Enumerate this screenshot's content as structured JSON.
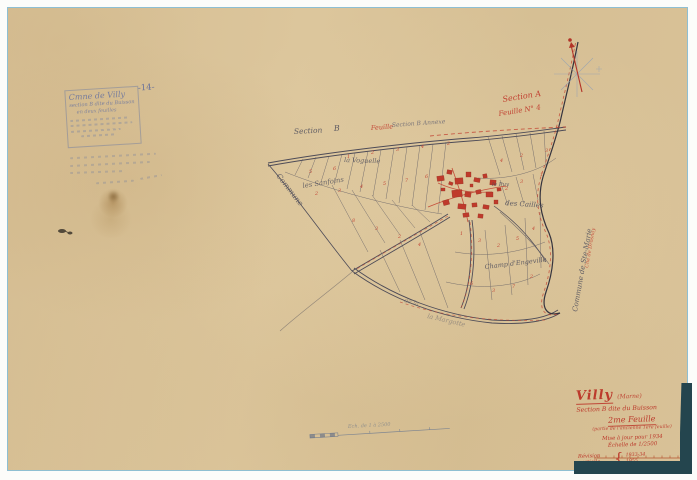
{
  "document_type": "cadastral-map-scan",
  "colors": {
    "paper": "#d8c298",
    "frame_blue": "#8fbfd2",
    "map_ink": "#4b4b5a",
    "red_ink": "#c03a2c",
    "pencil_blue": "#5f6da0",
    "backing": "#24454e"
  },
  "cartouche": {
    "line1": "Cmne de Villy",
    "line2": "section B dite du Buisson",
    "line3": "en deux feuilles",
    "page_mark": "-14-"
  },
  "title_block": {
    "commune": "Villy",
    "departement": "(Marne)",
    "section_line": "Section B dite du Buisson",
    "sheet": "2me Feuille",
    "sheet_note": "(partie de l'ancienne 1ère feuille)",
    "update_line": "Mise à jour pour 1934",
    "scale_line": "Échelle de 1/2500",
    "revision_label": "Révision partielle",
    "revision_entries": [
      "1933-34",
      "1955"
    ]
  },
  "icons": {
    "compass": "compass-rose-icon"
  },
  "map_labels": [
    {
      "t": "Section",
      "x": 294,
      "y": 134,
      "r": -3,
      "s": 7.5,
      "c": "#4b4b5a",
      "o": 0.85
    },
    {
      "t": "B",
      "x": 334,
      "y": 131,
      "r": -3,
      "s": 8,
      "c": "#4b4b5a",
      "o": 0.85
    },
    {
      "t": "Feuille",
      "x": 371,
      "y": 130,
      "r": -4,
      "s": 6.5,
      "c": "#c03a2c",
      "o": 0.9
    },
    {
      "t": "Section B Annexe",
      "x": 392,
      "y": 127,
      "r": -4,
      "s": 6,
      "c": "#5b5b6e",
      "o": 0.75
    },
    {
      "t": "Section A",
      "x": 503,
      "y": 102,
      "r": -9,
      "s": 8,
      "c": "#c03a2c",
      "o": 0.95
    },
    {
      "t": "Feuille N° 4",
      "x": 499,
      "y": 116,
      "r": -9,
      "s": 7,
      "c": "#c03a2c",
      "o": 0.95
    },
    {
      "t": "les Sanfoins",
      "x": 303,
      "y": 188,
      "r": -9,
      "s": 6.8,
      "c": "#4b4b5a",
      "o": 0.8
    },
    {
      "t": "la Voguelle",
      "x": 344,
      "y": 162,
      "r": 2,
      "s": 6.5,
      "c": "#4b4b5a",
      "o": 0.8
    },
    {
      "t": "le Puy",
      "x": 492,
      "y": 186,
      "r": 0,
      "s": 5.5,
      "c": "#4b4b5a",
      "o": 0.8
    },
    {
      "t": "des Cailles",
      "x": 505,
      "y": 205,
      "r": 4,
      "s": 7,
      "c": "#4b4b5a",
      "o": 0.85
    },
    {
      "t": "Champ d'Engeville",
      "x": 485,
      "y": 269,
      "r": -7,
      "s": 6.5,
      "c": "#4b4b5a",
      "o": 0.85
    },
    {
      "t": "Commune",
      "x": 276,
      "y": 176,
      "r": 52,
      "s": 7.5,
      "c": "#4b4b5a",
      "o": 0.8
    },
    {
      "t": "Commune de Ste-Marie",
      "x": 577,
      "y": 312,
      "r": -80,
      "s": 7,
      "c": "#4b4b5a",
      "o": 0.85
    },
    {
      "t": "Cne de Drosnay",
      "x": 588,
      "y": 268,
      "r": -80,
      "s": 5,
      "c": "#c03a2c",
      "o": 0.8
    },
    {
      "t": "de la",
      "x": 404,
      "y": 302,
      "r": 14,
      "s": 6,
      "c": "#5a5a68",
      "o": 0.5
    },
    {
      "t": "la Margotte",
      "x": 427,
      "y": 318,
      "r": 13,
      "s": 6.5,
      "c": "#5a5a68",
      "o": 0.5
    },
    {
      "t": "Ech. de 1 à 2500",
      "x": 348,
      "y": 428,
      "r": -3,
      "s": 5,
      "c": "#5a6a85",
      "o": 0.55
    }
  ],
  "parcel_numbers": [
    {
      "n": "1",
      "x": 347,
      "y": 158
    },
    {
      "n": "2",
      "x": 371,
      "y": 154
    },
    {
      "n": "3",
      "x": 396,
      "y": 151
    },
    {
      "n": "4",
      "x": 421,
      "y": 148
    },
    {
      "n": "2",
      "x": 447,
      "y": 145
    },
    {
      "n": "5",
      "x": 309,
      "y": 173
    },
    {
      "n": "6",
      "x": 333,
      "y": 170
    },
    {
      "n": "2",
      "x": 315,
      "y": 195
    },
    {
      "n": "3",
      "x": 338,
      "y": 192
    },
    {
      "n": "4",
      "x": 360,
      "y": 188
    },
    {
      "n": "5",
      "x": 383,
      "y": 185
    },
    {
      "n": "7",
      "x": 405,
      "y": 182
    },
    {
      "n": "6",
      "x": 425,
      "y": 178
    },
    {
      "n": "8",
      "x": 352,
      "y": 222
    },
    {
      "n": "3",
      "x": 375,
      "y": 230
    },
    {
      "n": "2",
      "x": 398,
      "y": 238
    },
    {
      "n": "4",
      "x": 418,
      "y": 246
    },
    {
      "n": "1",
      "x": 460,
      "y": 235
    },
    {
      "n": "3",
      "x": 478,
      "y": 242
    },
    {
      "n": "2",
      "x": 497,
      "y": 247
    },
    {
      "n": "5",
      "x": 516,
      "y": 240
    },
    {
      "n": "4",
      "x": 532,
      "y": 230
    },
    {
      "n": "6",
      "x": 470,
      "y": 285
    },
    {
      "n": "3",
      "x": 492,
      "y": 292
    },
    {
      "n": "7",
      "x": 512,
      "y": 288
    },
    {
      "n": "2",
      "x": 530,
      "y": 278
    },
    {
      "n": "2",
      "x": 505,
      "y": 190
    },
    {
      "n": "3",
      "x": 520,
      "y": 183
    },
    {
      "n": "1",
      "x": 540,
      "y": 176
    },
    {
      "n": "4",
      "x": 500,
      "y": 162
    },
    {
      "n": "2",
      "x": 520,
      "y": 157
    },
    {
      "n": "3",
      "x": 545,
      "y": 152
    }
  ]
}
